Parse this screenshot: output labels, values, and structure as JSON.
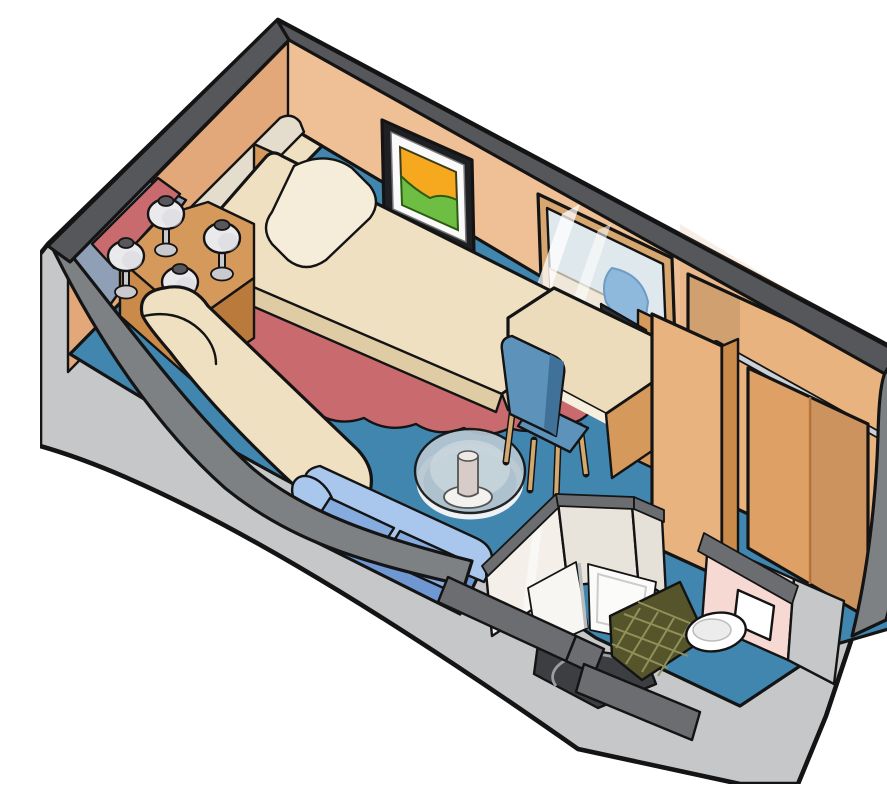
{
  "meta": {
    "title": "Cruise ship stateroom cutaway floor plan",
    "description": "Isometric cutaway illustration of a cabin stateroom with twin beds, corner table with reading lamps, wall art, vanity desk with mirror and chair, television, wardrobe with hanging rail, chaise and sofa along curved hull wall, glass coffee table, and bathroom with shower, tiled floor and toilet"
  },
  "colors": {
    "white": "#ffffff",
    "outline": "#141414",
    "outer-face": "#c6c7c9",
    "outer-face-dim": "#b2b3b6",
    "band-dark": "#56575a",
    "band-mid": "#7e8184",
    "cap-gray": "#6b6d70",
    "wall-tan": "#efc096",
    "wall-tan-dark": "#e3a87a",
    "floor-blue": "#4186af",
    "floor-slate": "#8fa0b6",
    "rug-red": "#c96b6e",
    "bed-cream": "#f0e0c2",
    "bed-cream-dark": "#dfcba4",
    "pillow-cream": "#f5edd9",
    "bolster-gray": "#e4dccd",
    "wood": "#d6995c",
    "wood-dark": "#b97a3c",
    "wood-light": "#e8b37e",
    "wood-door": "#dfa066",
    "wood-edge": "#c98a4a",
    "lamp-white": "#eaeaed",
    "lamp-gray": "#c9c9ce",
    "lamp-cap": "#58585c",
    "sofa-light": "#a9c6ec",
    "sofa-mid": "#86abdf",
    "sofa-deep": "#6f97d2",
    "chair-blue": "#5d92bb",
    "chair-blue-dark": "#3f7199",
    "leg-tan": "#d3a96f",
    "glass-blue": "#b7c6d1",
    "glass-inner": "#cdd9e0",
    "glass-rim": "#eef2f4",
    "vase-tan": "#d8ccc9",
    "desk-cream": "#eddcbc",
    "mirror-frame": "#d8a76f",
    "mirror-glass": "#dfe8ec",
    "mirror-reflect": "#efe8da",
    "mirror-chair": "#8fb8dd",
    "frame-black": "#1f2023",
    "art-orange": "#f6a81f",
    "art-green": "#6fbe44",
    "mat-white": "#fafafa",
    "tv-dark": "#2c3136",
    "tv-screen": "#49525a",
    "bath-white": "#f4f0e9",
    "bath-white-dim": "#e9e4db",
    "pan-white": "#f7f6f3",
    "tray-white": "#fbfbfa",
    "shower-dark": "#3c3e41",
    "arc-gray": "#9b9ea1",
    "tile-olive": "#55542a",
    "tile-line": "#90905a",
    "pink-wall": "#f7d9d3",
    "toilet-white": "#ffffff",
    "rail-metal": "#ccd1d6"
  },
  "scene": {
    "parts": [
      {
        "id": "hull-shell",
        "label": "Outer hull and cabin shell"
      },
      {
        "id": "cabin-walls",
        "label": "Interior cabin walls"
      },
      {
        "id": "carpet",
        "label": "Blue carpet"
      },
      {
        "id": "accent-rug",
        "label": "Red accent rug around beds"
      },
      {
        "id": "twin-bed-left",
        "label": "Twin bed along left wall"
      },
      {
        "id": "twin-bed-main",
        "label": "Main twin bed with headboard"
      },
      {
        "id": "corner-table",
        "label": "Corner table nightstand"
      },
      {
        "id": "reading-lamps",
        "label": "Four reading lamps"
      },
      {
        "id": "chaise",
        "label": "Cream chaise along hull"
      },
      {
        "id": "sofa",
        "label": "Blue sofa"
      },
      {
        "id": "coffee-table",
        "label": "Round glass coffee table"
      },
      {
        "id": "wall-art",
        "label": "Framed abstract artwork"
      },
      {
        "id": "mirror",
        "label": "Vanity mirror"
      },
      {
        "id": "desk",
        "label": "Vanity desk"
      },
      {
        "id": "chair",
        "label": "Desk chair"
      },
      {
        "id": "television",
        "label": "Television on cabinet"
      },
      {
        "id": "wardrobe",
        "label": "Wardrobe with hanging rail"
      },
      {
        "id": "bathroom",
        "label": "Bathroom pod with shower"
      },
      {
        "id": "toilet",
        "label": "Toilet"
      },
      {
        "id": "entry",
        "label": "Entry corridor"
      }
    ]
  }
}
